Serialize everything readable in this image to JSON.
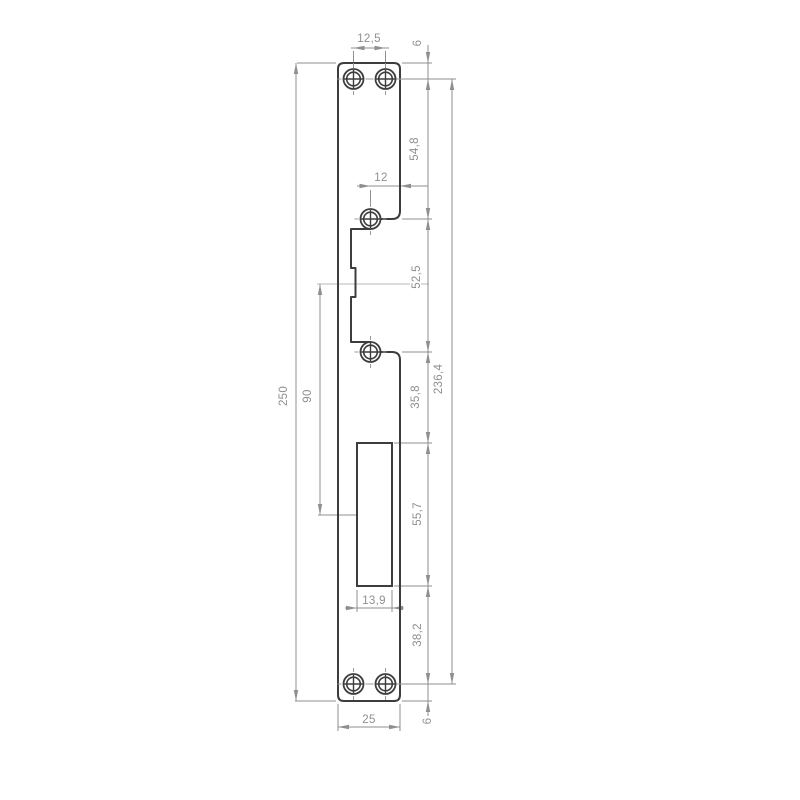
{
  "drawing": {
    "colors": {
      "background": "#ffffff",
      "outline": "#3d3d3d",
      "dimension": "#8f8f8f",
      "centerline": "#b8b8b8"
    },
    "dimensions": {
      "top_hole_spacing": "12,5",
      "top_edge_to_holes": "6",
      "top_holes_to_mid_hole": "54,8",
      "mid_hole_to_edge": "12",
      "mid_hole_spacing": "52,5",
      "plate_length": "250",
      "center_to_latch_ref": "90",
      "hole_span_total": "236,4",
      "mid_hole_to_cutout": "35,8",
      "cutout_length": "55,7",
      "cutout_width": "13,9",
      "cutout_to_bottom_holes": "38,2",
      "plate_width": "25",
      "bottom_edge_to_holes": "6"
    }
  }
}
